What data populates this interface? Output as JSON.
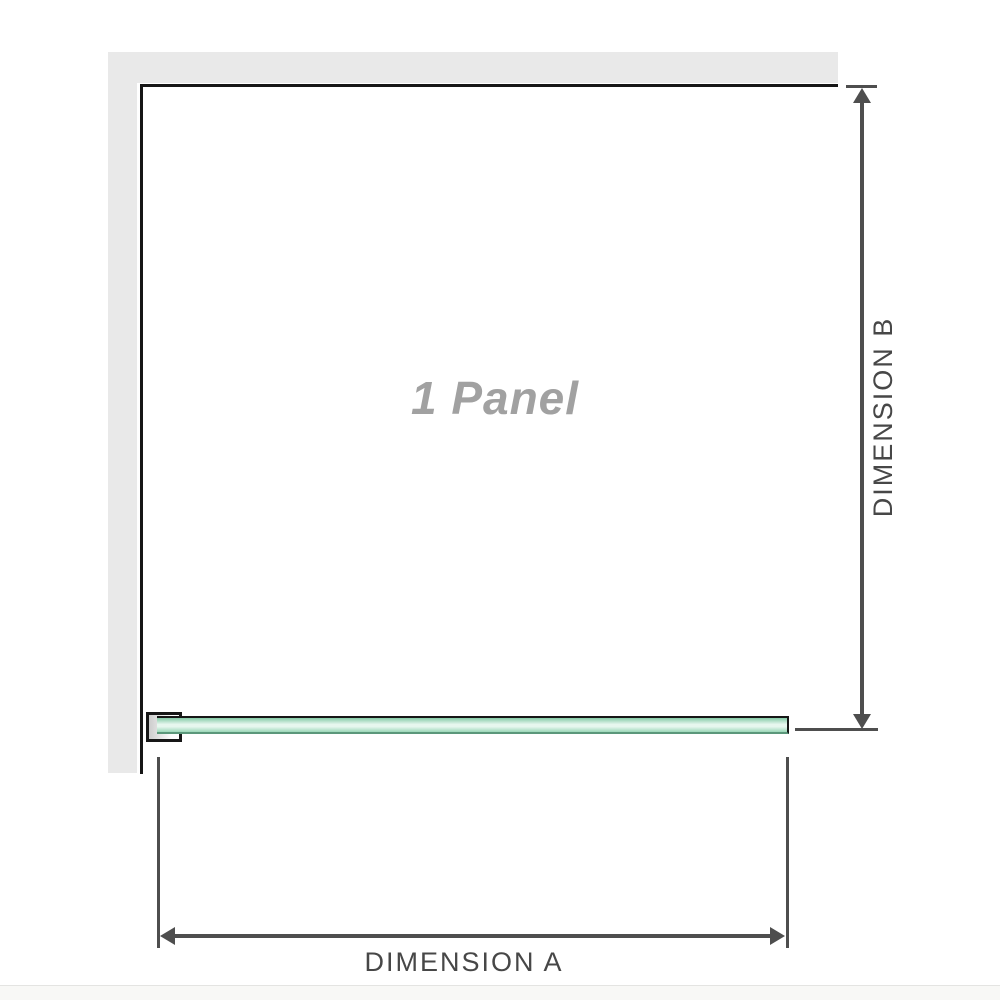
{
  "diagram": {
    "panel_label": "1 Panel",
    "dimension_a": {
      "label": "DIMENSION A"
    },
    "dimension_b": {
      "label": "DIMENSION B"
    }
  },
  "colors": {
    "wall": "#e9e9e9",
    "wall_edge": "#161616",
    "dimension": "#4e4e4e",
    "label_text": "#474747",
    "panel_label_text": "#a1a1a1",
    "glass_top": "#84cba7",
    "glass_light": "#e7f7ee",
    "glass_bottom": "#9bd7b8",
    "glass_edge": "#5b977a"
  }
}
